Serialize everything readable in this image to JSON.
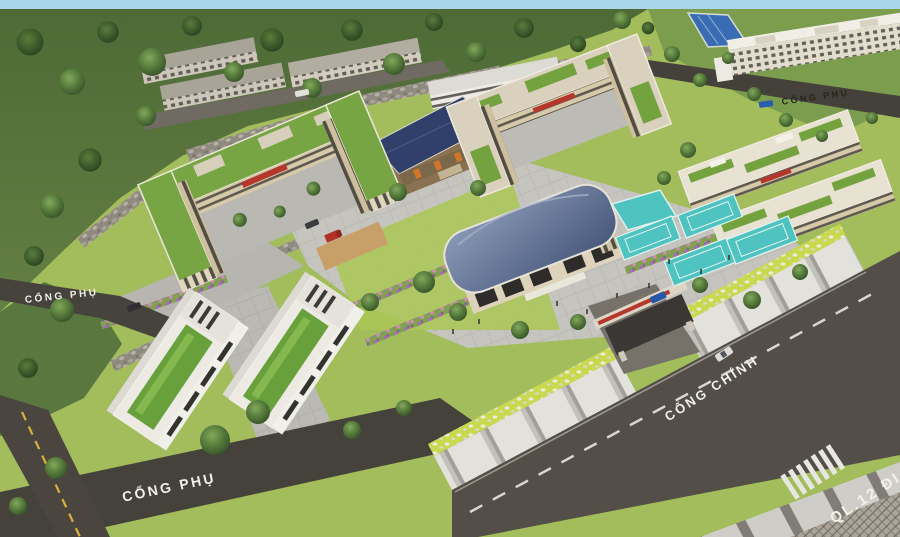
{
  "scene": {
    "labels": {
      "left_side_gate": "CỔNG PHỤ",
      "bottom_side_gate": "CỔNG PHỤ",
      "top_side_gate": "CỔNG PHỤ",
      "main_gate": "CỔNG CHÍNH",
      "highway": "QL.12 ĐI"
    },
    "colors": {
      "sky": "#A9D6EA",
      "hill_green": "#57743C",
      "tree_green": "#3E5A2C",
      "lawn_green": "#A3BC5C",
      "grass_strip": "#C9D94E",
      "plaza_gray": "#C5C4BF",
      "road_asphalt": "#4B4740",
      "building_cream": "#D7CAAA",
      "building_white": "#ECEAE3",
      "roof_green": "#78A544",
      "gym_roof_blue": "#5C6C8E",
      "stilt_roof_blue": "#31406A",
      "pool_blue": "#3A6CB4",
      "court_teal": "#4FC3BF",
      "flower_purple": "#A76AB8",
      "flower_pink": "#D08AB8",
      "sign_red": "#B5372B",
      "label_white": "#F2F1EC",
      "label_dark": "#26241F"
    }
  }
}
